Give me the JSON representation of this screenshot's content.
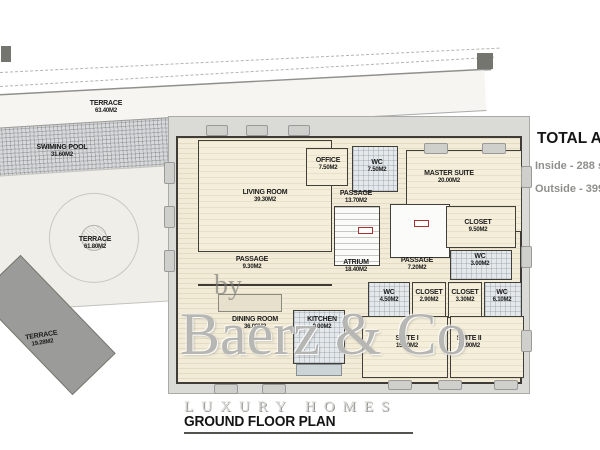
{
  "plan": {
    "rooms": [
      {
        "name": "TERRACE",
        "area": "63.40M2"
      },
      {
        "name": "SWIMING POOL",
        "area": "31.60M2"
      },
      {
        "name": "TERRACE",
        "area": "61.80M2"
      },
      {
        "name": "TERRACE",
        "area": "19.28M2"
      },
      {
        "name": "LIVING ROOM",
        "area": "39.30M2"
      },
      {
        "name": "OFFICE",
        "area": "7.50M2"
      },
      {
        "name": "WC",
        "area": "7.50M2"
      },
      {
        "name": "MASTER SUITE",
        "area": "20.00M2"
      },
      {
        "name": "PASSAGE",
        "area": "13.70M2"
      },
      {
        "name": "CLOSET",
        "area": "9.50M2"
      },
      {
        "name": "ATRIUM",
        "area": "18.40M2"
      },
      {
        "name": "PASSAGE",
        "area": "7.20M2"
      },
      {
        "name": "WC",
        "area": "3.00M2"
      },
      {
        "name": "PASSAGE",
        "area": "9.30M2"
      },
      {
        "name": "WC",
        "area": "4.50M2"
      },
      {
        "name": "CLOSET",
        "area": "2.90M2"
      },
      {
        "name": "CLOSET",
        "area": "3.30M2"
      },
      {
        "name": "WC",
        "area": "6.10M2"
      },
      {
        "name": "DINING ROOM",
        "area": "36.00M2"
      },
      {
        "name": "KITCHEN",
        "area": "9.00M2"
      },
      {
        "name": "SUITE I",
        "area": "15.10M2"
      },
      {
        "name": "SUITE II",
        "area": "14.90M2"
      }
    ],
    "totals": {
      "title": "TOTAL AREAS",
      "inside": "Inside - 288 sqm",
      "outside": "Outside - 399 sqm"
    },
    "footer_title": "GROUND FLOOR PLAN"
  },
  "watermark": {
    "by": "by",
    "brand": "Baerz & Co",
    "tagline": "LUXURY HOMES"
  },
  "colors": {
    "floor_beige": "#f2ebd7",
    "tile_gray": "#e4e8ea",
    "deck_gray": "#dadad7",
    "dark_terrace": "#9b9b99",
    "wall": "#413f3a",
    "door_marker_red": "#a83232",
    "watermark_gray": "#b5b5b2",
    "text_black": "#1a1a1a",
    "muted_text": "#8f8f8d"
  }
}
